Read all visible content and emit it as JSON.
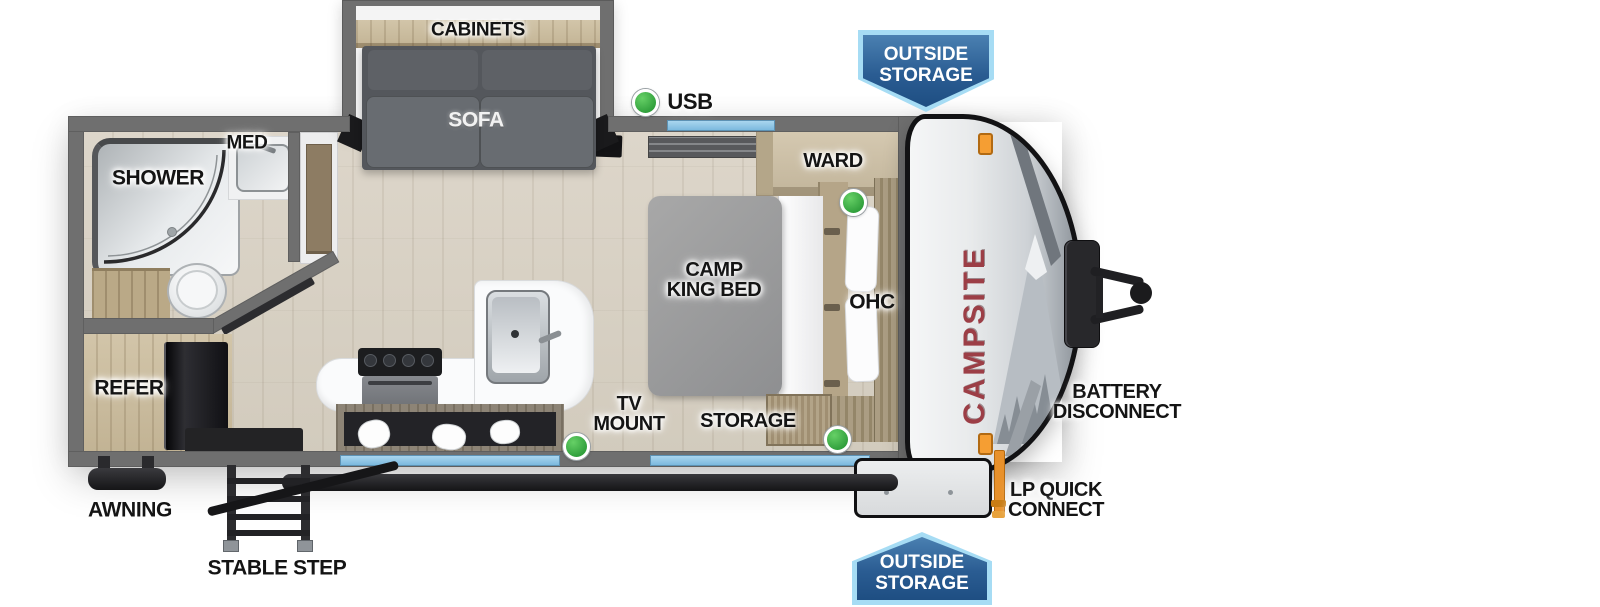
{
  "title": "Campsite travel trailer floor plan",
  "labels": {
    "cabinets": "CABINETS",
    "sofa": "SOFA",
    "usb": "USB",
    "med": "MED",
    "shower": "SHOWER",
    "refer": "REFER",
    "ward": "WARD",
    "bed_line1": "CAMP",
    "bed_line2": "KING BED",
    "ohc": "OHC",
    "storage": "STORAGE",
    "tv_line1": "TV",
    "tv_line2": "MOUNT",
    "battery_line1": "BATTERY",
    "battery_line2": "DISCONNECT",
    "lp_line1": "LP QUICK",
    "lp_line2": "CONNECT",
    "awning": "AWNING",
    "stable_step": "STABLE STEP",
    "brand_graphic": "CAMPSITE"
  },
  "badges": {
    "top": {
      "line1": "OUTSIDE",
      "line2": "STORAGE"
    },
    "bottom": {
      "line1": "OUTSIDE",
      "line2": "STORAGE"
    }
  },
  "colors": {
    "badge_blue_dark": "#2a5c92",
    "badge_blue_border": "#a6dcf4",
    "window_blue": "#8fc7e8",
    "indicator_green": "#3aae46",
    "brand_red": "#9c3e46",
    "wall_gray": "#6f6f6f",
    "marker_orange": "#f59e33"
  }
}
